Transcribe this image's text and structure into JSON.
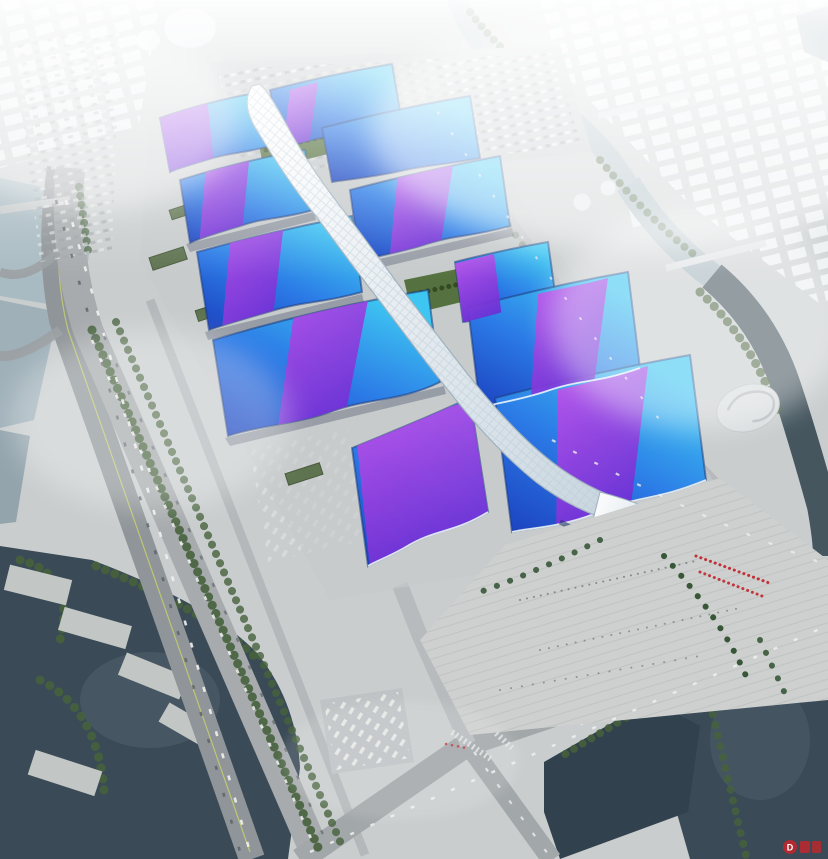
{
  "watermark": {
    "logo_letter": "D"
  },
  "palette": {
    "sky_grey": "#e3e9ed",
    "ground": "#c9cdce",
    "city_block": "#f1f5f7",
    "roof_deep": "#1b3fbe",
    "roof_mid": "#2b7ae6",
    "roof_cyan": "#3ec6f2",
    "roof_edge": "#16306b",
    "ribbon_violet": "#6f2fd4",
    "ribbon_magenta": "#c653ec",
    "spine_white": "#ffffff",
    "spine_shade": "#c6d4de",
    "water_dark": "#3a4a56",
    "water_basin": "#31414d",
    "water_light": "#a9bbc2",
    "green_tree": "#46613c",
    "green_lawn": "#7c9468",
    "green_roof": "#5e7350",
    "road_grey": "#9aa0a3",
    "pavement": "#cdd0ce",
    "accent_red": "#c0272d",
    "haze_white": "#ffffff"
  }
}
